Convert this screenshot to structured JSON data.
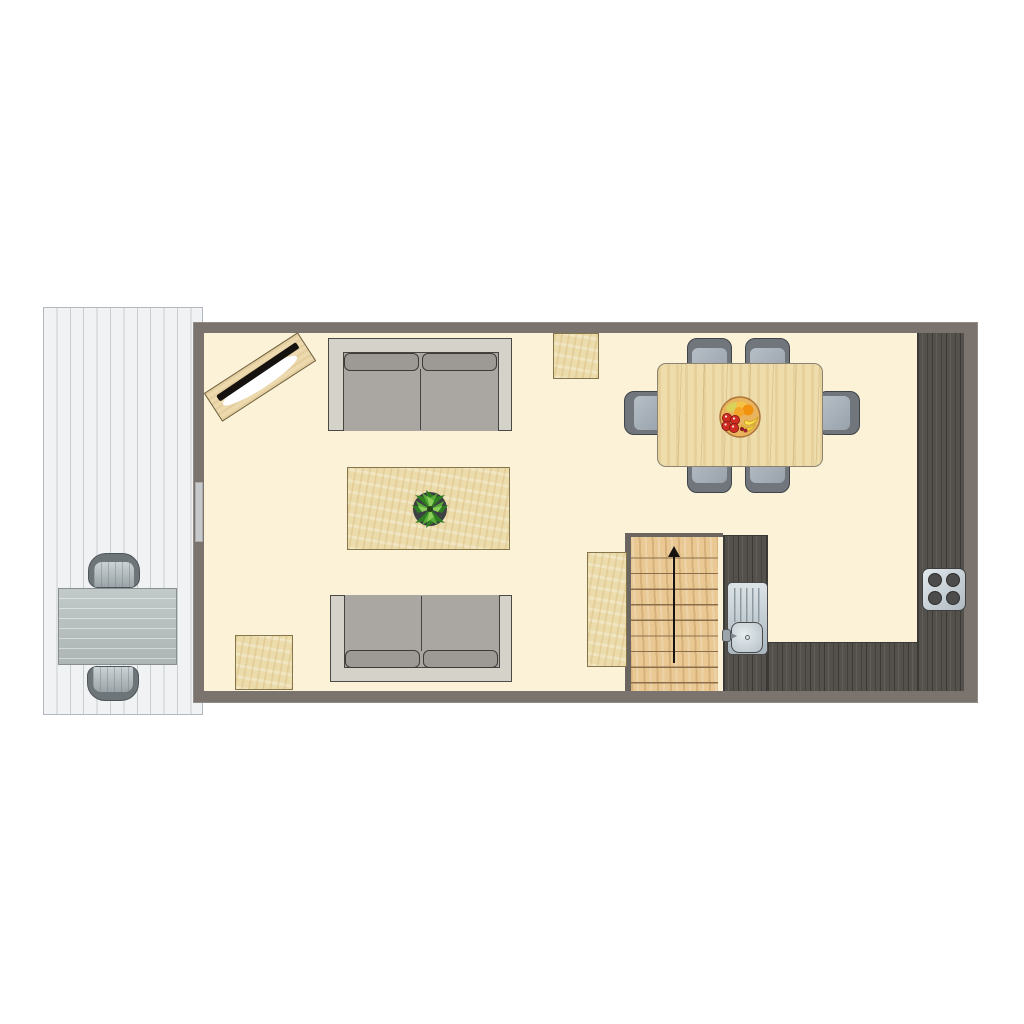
{
  "title": "Apartment floor plan – ground floor",
  "colors": {
    "background": "#ffffff",
    "wall": "#7a736e",
    "floor": "#fcf2d8",
    "deck": "#f0f2f4",
    "counter-dark-wood": "#54514c",
    "stair-wood": "#e9c894",
    "rug-tan": "#ecdcab",
    "sofa-base": "#d5d3c9",
    "sofa-seat": "#aaa6a2",
    "dining-table-wood": "#eedcaa",
    "chair-slate": "#a5adb5",
    "metal": "#c3ced4"
  },
  "areas": {
    "deck": {
      "label": "Outdoor deck with plank flooring"
    },
    "living": {
      "label": "Living room"
    },
    "dining": {
      "label": "Dining area"
    },
    "kitchen": {
      "label": "Kitchen with dark wood counters"
    },
    "stairs": {
      "label": "Staircase leading up",
      "direction": "up"
    }
  },
  "furniture": {
    "deck_table": {
      "label": "Outdoor table"
    },
    "deck_chair_top": {
      "label": "Outdoor chair"
    },
    "deck_chair_bottom": {
      "label": "Outdoor chair"
    },
    "door": {
      "label": "Door to deck"
    },
    "tv_console": {
      "label": "TV on media sideboard (corner)"
    },
    "sofa_top": {
      "label": "Two-seat sofa"
    },
    "sofa_bottom": {
      "label": "Two-seat sofa"
    },
    "coffee_table": {
      "label": "Coffee table"
    },
    "plant": {
      "label": "Potted plant"
    },
    "rug_top": {
      "label": "Small square mat"
    },
    "rug_bottom": {
      "label": "Small square mat"
    },
    "rug_stairs": {
      "label": "Runner mat beside stairs"
    },
    "dining_table": {
      "label": "Dining table"
    },
    "dining_chairs": {
      "label": "Dining chair",
      "count": 6
    },
    "fruit_bowl": {
      "label": "Fruit bowl"
    },
    "sink": {
      "label": "Kitchen sink with drainboard"
    },
    "cooktop": {
      "label": "Four-burner cooktop",
      "burners": 4
    }
  }
}
